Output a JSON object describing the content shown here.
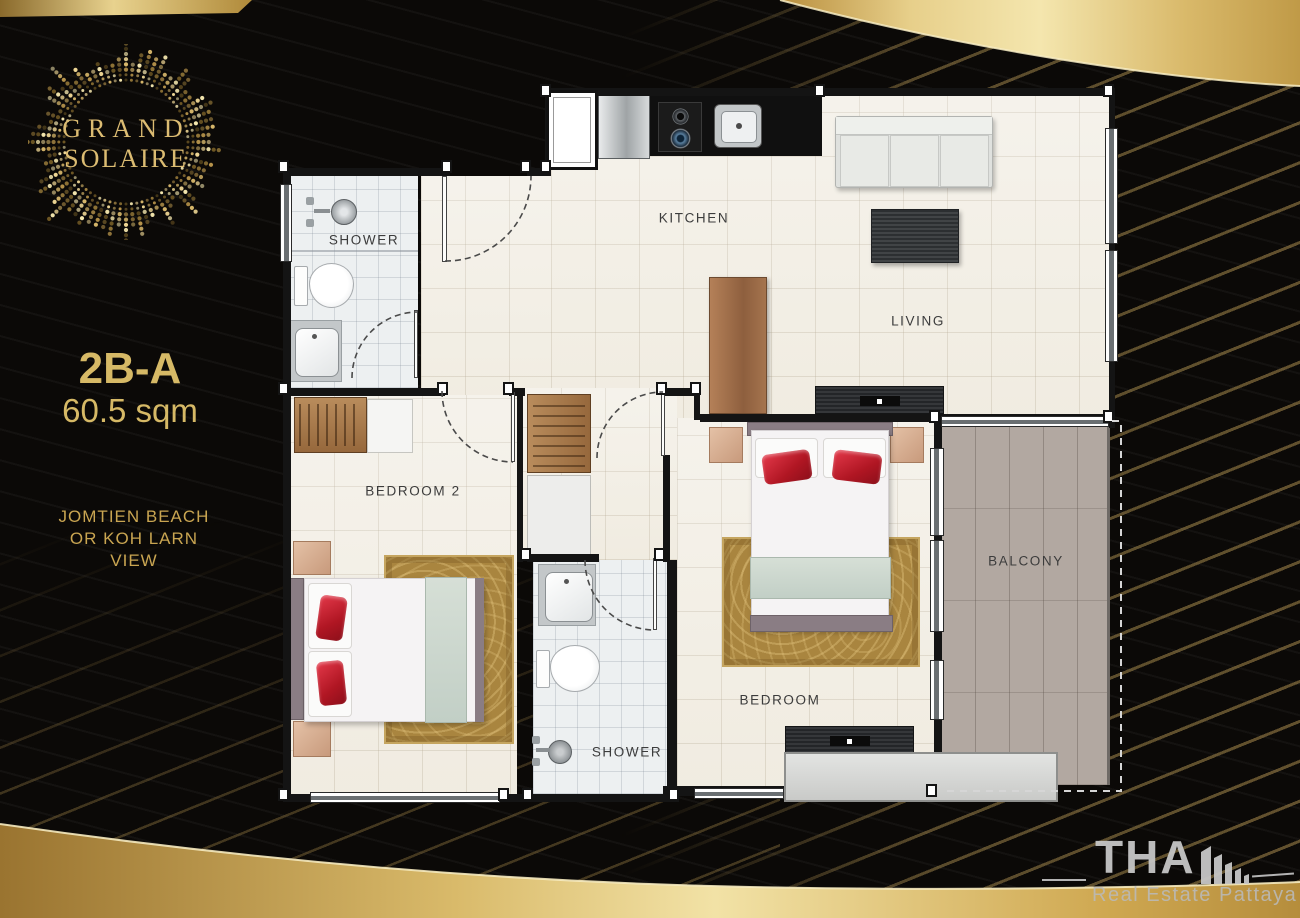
{
  "branding": {
    "logo_top": "GRAND",
    "logo_bottom": "SOLAIRE"
  },
  "unit": {
    "code": "2B-A",
    "area": "60.5 sqm",
    "view_lines": [
      "JOMTIEN BEACH",
      "OR KOH LARN",
      "VIEW"
    ]
  },
  "plan": {
    "labels": {
      "kitchen": "KITCHEN",
      "living": "LIVING",
      "balcony": "BALCONY",
      "bedroom": "BEDROOM",
      "bedroom2": "BEDROOM 2",
      "shower_top": "SHOWER",
      "shower_bottom": "SHOWER"
    }
  },
  "watermark": {
    "brand": "THA",
    "tagline": "Real Estate Pattaya"
  },
  "colors": {
    "gold_text": "#d6b966",
    "gold_band_light": "#f2e2a6",
    "gold_band_dark": "#9a7430",
    "wall": "#141414",
    "marble_floor": "#f1ede3",
    "bath_floor": "#edf0f1",
    "balcony_floor": "#b2a8a1",
    "accent_red": "#c9202e",
    "label_text": "#3c3c3c"
  }
}
